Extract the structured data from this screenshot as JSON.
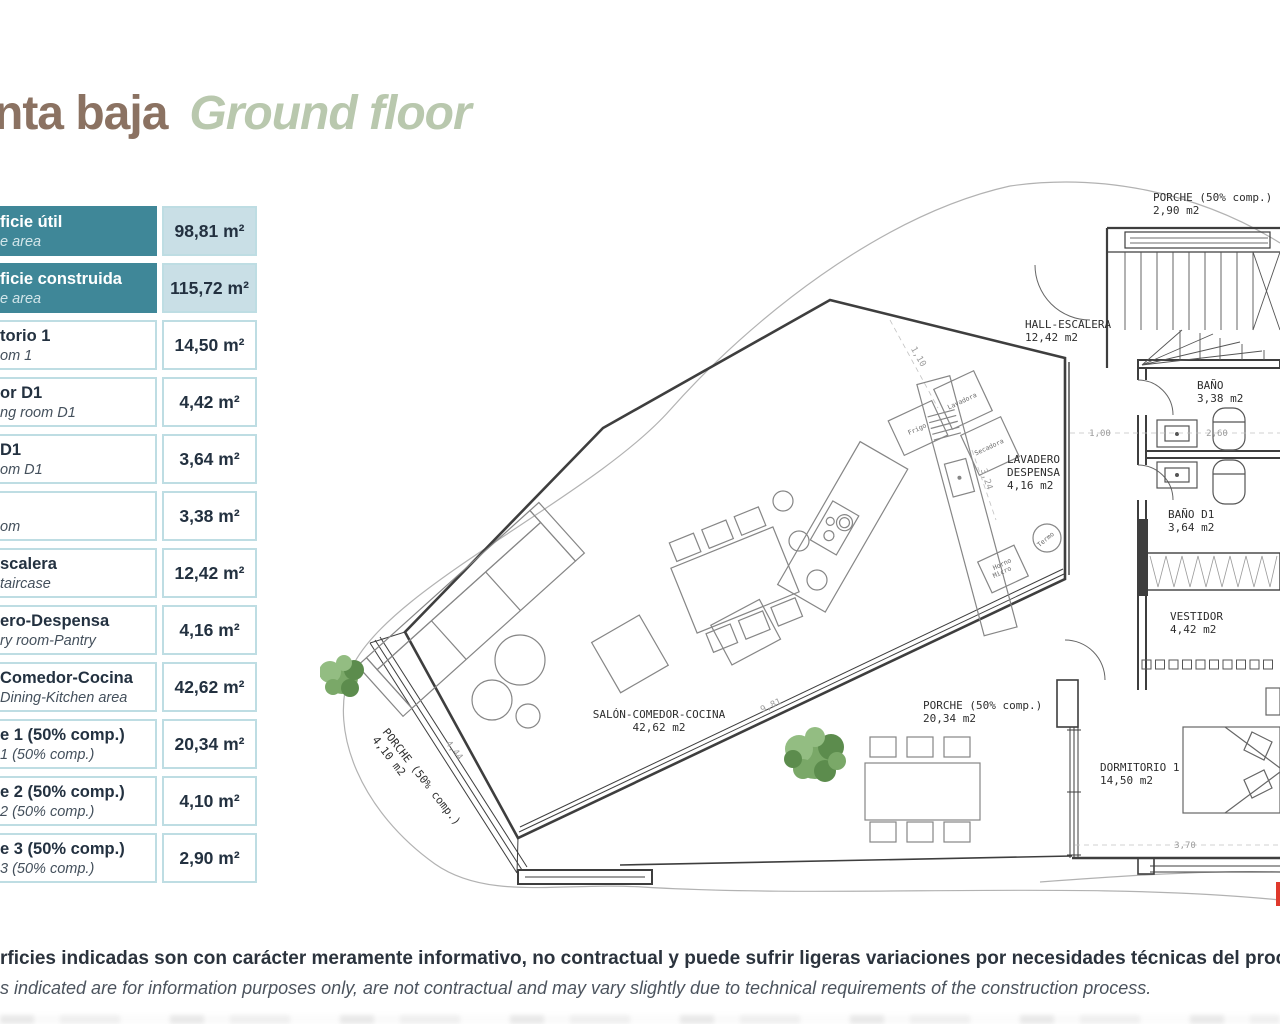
{
  "title": {
    "es_fragment": "nta baja",
    "en": "Ground floor"
  },
  "table": {
    "rows": [
      {
        "es": "ficie útil",
        "en": "e area",
        "value": "98,81 m²",
        "header": true
      },
      {
        "es": "ficie construida",
        "en": "e area",
        "value": "115,72 m²",
        "header": true
      },
      {
        "es": "torio 1",
        "en": "om 1",
        "value": "14,50 m²",
        "header": false
      },
      {
        "es": "or D1",
        "en": "ng room D1",
        "value": "4,42 m²",
        "header": false
      },
      {
        "es": "D1",
        "en": "om D1",
        "value": "3,64 m²",
        "header": false
      },
      {
        "es": "",
        "en": "om",
        "value": "3,38 m²",
        "header": false
      },
      {
        "es": "scalera",
        "en": "taircase",
        "value": "12,42 m²",
        "header": false
      },
      {
        "es": "ero-Despensa",
        "en": "ry room-Pantry",
        "value": "4,16 m²",
        "header": false
      },
      {
        "es": "Comedor-Cocina",
        "en": "Dining-Kitchen area",
        "value": "42,62 m²",
        "header": false
      },
      {
        "es": "e 1 (50% comp.)",
        "en": "1 (50% comp.)",
        "value": "20,34 m²",
        "header": false
      },
      {
        "es": "e 2 (50% comp.)",
        "en": "2 (50% comp.)",
        "value": "4,10 m²",
        "header": false
      },
      {
        "es": "e 3 (50% comp.)",
        "en": "3 (50% comp.)",
        "value": "2,90 m²",
        "header": false
      }
    ]
  },
  "plan": {
    "labels": [
      {
        "lines": [
          "PORCHE (50% comp.)",
          "2,90 m2"
        ],
        "x": 833,
        "y": 31,
        "rot": 0,
        "anchor": "start"
      },
      {
        "lines": [
          "HALL-ESCALERA",
          "12,42 m2"
        ],
        "x": 705,
        "y": 158,
        "rot": 0,
        "anchor": "start"
      },
      {
        "lines": [
          "BAÑO",
          "3,38 m2"
        ],
        "x": 877,
        "y": 219,
        "rot": 0,
        "anchor": "start"
      },
      {
        "lines": [
          "LAVADERO",
          "DESPENSA",
          "4,16 m2"
        ],
        "x": 687,
        "y": 293,
        "rot": 0,
        "anchor": "start"
      },
      {
        "lines": [
          "BAÑO D1",
          "3,64 m2"
        ],
        "x": 848,
        "y": 348,
        "rot": 0,
        "anchor": "start"
      },
      {
        "lines": [
          "VESTIDOR",
          "4,42 m2"
        ],
        "x": 850,
        "y": 450,
        "rot": 0,
        "anchor": "start"
      },
      {
        "lines": [
          "SALÓN-COMEDOR-COCINA",
          "42,62 m2"
        ],
        "x": 339,
        "y": 548,
        "rot": 0,
        "anchor": "middle"
      },
      {
        "lines": [
          "PORCHE (50% comp.)",
          "20,34 m2"
        ],
        "x": 603,
        "y": 539,
        "rot": 0,
        "anchor": "start"
      },
      {
        "lines": [
          "DORMITORIO 1",
          "14,50 m2"
        ],
        "x": 780,
        "y": 601,
        "rot": 0,
        "anchor": "start"
      },
      {
        "lines": [
          "PORCHE (50% comp.)",
          "4,10 m2"
        ],
        "x": 62,
        "y": 562,
        "rot": 52,
        "anchor": "start"
      }
    ],
    "dims": [
      {
        "t": "1,00",
        "x": 780,
        "y": 266,
        "rot": 0
      },
      {
        "t": "2,60",
        "x": 897,
        "y": 266,
        "rot": 0
      },
      {
        "t": "3,70",
        "x": 865,
        "y": 678,
        "rot": 0
      },
      {
        "t": "9,81",
        "x": 452,
        "y": 538,
        "rot": -25
      },
      {
        "t": "4,44",
        "x": 132,
        "y": 582,
        "rot": 52
      },
      {
        "t": "1,10",
        "x": 596,
        "y": 188,
        "rot": 60
      },
      {
        "t": "3,24",
        "x": 664,
        "y": 310,
        "rot": 72
      }
    ],
    "appliances": [
      {
        "t": "Frigo",
        "x": 598,
        "y": 261,
        "rot": -25
      },
      {
        "t": "Lavadora",
        "x": 643,
        "y": 233,
        "rot": -25
      },
      {
        "t": "Secadora",
        "x": 670,
        "y": 279,
        "rot": -25
      },
      {
        "t": "Termo",
        "x": 727,
        "y": 371,
        "rot": -40
      },
      {
        "t": "Horno",
        "x": 683,
        "y": 396,
        "rot": -25
      },
      {
        "t": "Micro",
        "x": 683,
        "y": 404,
        "rot": -25
      }
    ]
  },
  "disclaimer": {
    "es": "rficies indicadas son con carácter meramente informativo, no contractual y puede sufrir ligeras variaciones por necesidades técnicas del proceso de construcción",
    "en": "s indicated are for information purposes only, are not contractual and may vary slightly due to technical requirements of the construction process."
  },
  "colors": {
    "accent_teal": "#3F8798",
    "header_value_bg": "#C9DFE6",
    "cell_border": "#BEDDE3",
    "title_brown": "#8B7262",
    "title_green": "#B9C8AE",
    "red_mark": "#E0392C"
  }
}
